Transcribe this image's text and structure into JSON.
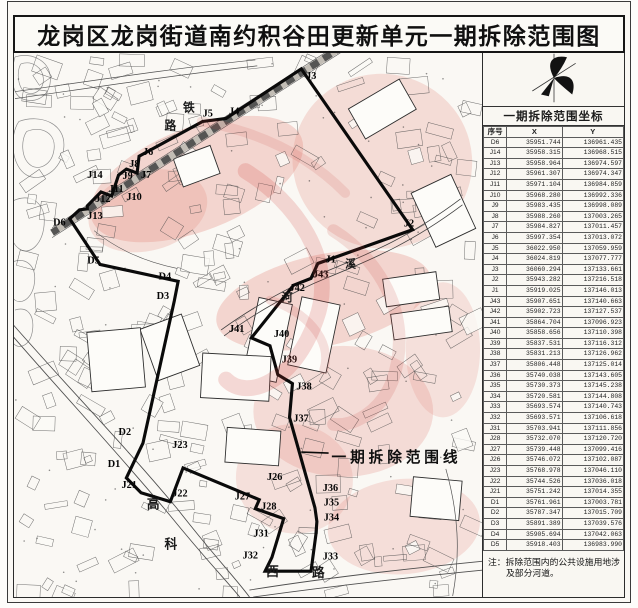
{
  "title": "龙岗区龙岗街道南约积谷田更新单元一期拆除范围图",
  "legend": {
    "label": "一期拆除范围线",
    "x": 338,
    "y": 463,
    "leader": [
      307,
      453,
      335,
      454
    ]
  },
  "note": "注：拆除范围内的公共设施用地涉及部分河道。",
  "colors": {
    "demolition_fill": "#e3847a",
    "boundary": "#0a0a0a",
    "watermark": "#cc3a33",
    "paper": "#faf8f4",
    "parcel_line": "#4a4a4a"
  },
  "map": {
    "railway_chars": [
      {
        "t": "铁",
        "x": 186,
        "y": 110
      },
      {
        "t": "路",
        "x": 167,
        "y": 128
      }
    ],
    "river_chars": [
      {
        "t": "溪",
        "x": 352,
        "y": 267
      },
      {
        "t": "河",
        "x": 287,
        "y": 301
      }
    ],
    "road_chars": [
      {
        "t": "高",
        "x": 149,
        "y": 510
      },
      {
        "t": "科",
        "x": 167,
        "y": 550
      },
      {
        "t": "西",
        "x": 271,
        "y": 578
      },
      {
        "t": "路",
        "x": 318,
        "y": 579
      }
    ],
    "vertices": [
      {
        "id": "D6",
        "vx": 70,
        "vy": 218,
        "lx": 53,
        "ly": 225
      },
      {
        "id": "J14",
        "vx": 80,
        "vy": 209,
        "lx": 88,
        "ly": 177
      },
      {
        "id": "J13",
        "vx": 88,
        "vy": 208,
        "lx": 88,
        "ly": 218
      },
      {
        "id": "J12",
        "vx": 88,
        "vy": 205,
        "lx": 96,
        "ly": 201
      },
      {
        "id": "J11",
        "vx": 102,
        "vy": 191,
        "lx": 110,
        "ly": 191
      },
      {
        "id": "J10",
        "vx": 113,
        "vy": 195,
        "lx": 128,
        "ly": 199
      },
      {
        "id": "J9",
        "vx": 120,
        "vy": 174,
        "lx": 124,
        "ly": 178
      },
      {
        "id": "J8",
        "vx": 128,
        "vy": 168,
        "lx": 131,
        "ly": 166
      },
      {
        "id": "J7",
        "vx": 139,
        "vy": 172,
        "lx": 143,
        "ly": 177
      },
      {
        "id": "J6",
        "vx": 141,
        "vy": 155,
        "lx": 145,
        "ly": 154
      },
      {
        "id": "J5",
        "vx": 206,
        "vy": 120,
        "lx": 206,
        "ly": 115
      },
      {
        "id": "J4",
        "vx": 230,
        "vy": 117,
        "lx": 233,
        "ly": 113
      },
      {
        "id": "J3",
        "vx": 307,
        "vy": 67,
        "lx": 312,
        "ly": 77
      },
      {
        "id": "J2",
        "vx": 421,
        "vy": 229,
        "lx": 412,
        "ly": 226
      },
      {
        "id": "J1",
        "vx": 324,
        "vy": 263,
        "lx": 332,
        "ly": 262
      },
      {
        "id": "J43",
        "vx": 317,
        "vy": 278,
        "lx": 319,
        "ly": 277
      },
      {
        "id": "J42",
        "vx": 299,
        "vy": 285,
        "lx": 295,
        "ly": 291
      },
      {
        "id": "J41",
        "vx": 256,
        "vy": 338,
        "lx": 233,
        "ly": 332
      },
      {
        "id": "J40",
        "vx": 275,
        "vy": 346,
        "lx": 279,
        "ly": 337
      },
      {
        "id": "J39",
        "vx": 283,
        "vy": 375,
        "lx": 287,
        "ly": 363
      },
      {
        "id": "J38",
        "vx": 298,
        "vy": 384,
        "lx": 302,
        "ly": 390
      },
      {
        "id": "J37",
        "vx": 295,
        "vy": 418,
        "lx": 299,
        "ly": 422
      },
      {
        "id": "J36",
        "vx": 321,
        "vy": 509,
        "lx": 329,
        "ly": 492
      },
      {
        "id": "J35",
        "vx": 323,
        "vy": 523,
        "lx": 330,
        "ly": 507
      },
      {
        "id": "J34",
        "vx": 322,
        "vy": 536,
        "lx": 330,
        "ly": 522
      },
      {
        "id": "J33",
        "vx": 317,
        "vy": 573,
        "lx": 329,
        "ly": 561
      },
      {
        "id": "J32",
        "vx": 270,
        "vy": 573,
        "lx": 247,
        "ly": 560
      },
      {
        "id": "J31",
        "vx": 277,
        "vy": 559,
        "lx": 258,
        "ly": 538
      },
      {
        "id": "J28",
        "vx": 289,
        "vy": 520,
        "lx": 266,
        "ly": 511
      },
      {
        "id": "J27",
        "vx": 260,
        "vy": 510,
        "lx": 239,
        "ly": 501
      },
      {
        "id": "J26",
        "vx": 264,
        "vy": 501,
        "lx": 272,
        "ly": 481
      },
      {
        "id": "J23",
        "vx": 186,
        "vy": 469,
        "lx": 175,
        "ly": 449
      },
      {
        "id": "J22",
        "vx": 173,
        "vy": 503,
        "lx": 175,
        "ly": 498
      },
      {
        "id": "J21",
        "vx": 143,
        "vy": 494,
        "lx": 123,
        "ly": 489
      },
      {
        "id": "D1",
        "vx": 128,
        "vy": 479,
        "lx": 109,
        "ly": 468
      },
      {
        "id": "D2",
        "vx": 145,
        "vy": 444,
        "lx": 120,
        "ly": 436
      },
      {
        "id": "D3",
        "vx": 177,
        "vy": 301,
        "lx": 159,
        "ly": 299
      },
      {
        "id": "D4",
        "vx": 181,
        "vy": 281,
        "lx": 161,
        "ly": 279
      },
      {
        "id": "D5",
        "vx": 101,
        "vy": 264,
        "lx": 88,
        "ly": 263
      }
    ]
  },
  "table": {
    "title": "一期拆除范围坐标",
    "columns": [
      "序号",
      "X",
      "Y"
    ],
    "rows": [
      [
        "D6",
        "35951.744",
        "136961.435"
      ],
      [
        "J14",
        "35958.315",
        "136968.515"
      ],
      [
        "J13",
        "35958.964",
        "136974.597"
      ],
      [
        "J12",
        "35961.307",
        "136974.347"
      ],
      [
        "J11",
        "35971.104",
        "136984.859"
      ],
      [
        "J10",
        "35968.280",
        "136992.336"
      ],
      [
        "J9",
        "35983.435",
        "136998.089"
      ],
      [
        "J8",
        "35988.260",
        "137003.265"
      ],
      [
        "J7",
        "35984.827",
        "137011.457"
      ],
      [
        "J6",
        "35997.354",
        "137013.072"
      ],
      [
        "J5",
        "36022.950",
        "137059.959"
      ],
      [
        "J4",
        "36024.819",
        "137077.777"
      ],
      [
        "J3",
        "36060.294",
        "137133.661"
      ],
      [
        "J2",
        "35943.282",
        "137216.518"
      ],
      [
        "J1",
        "35919.025",
        "137146.013"
      ],
      [
        "J43",
        "35907.651",
        "137140.663"
      ],
      [
        "J42",
        "35902.723",
        "137127.537"
      ],
      [
        "J41",
        "35864.704",
        "137096.923"
      ],
      [
        "J40",
        "35858.656",
        "137110.398"
      ],
      [
        "J39",
        "35837.531",
        "137116.312"
      ],
      [
        "J38",
        "35831.213",
        "137126.962"
      ],
      [
        "J37",
        "35806.448",
        "137125.014"
      ],
      [
        "J36",
        "35740.038",
        "137143.605"
      ],
      [
        "J35",
        "35730.373",
        "137145.238"
      ],
      [
        "J34",
        "35720.581",
        "137144.808"
      ],
      [
        "J33",
        "35693.574",
        "137140.743"
      ],
      [
        "J32",
        "35693.571",
        "137106.618"
      ],
      [
        "J31",
        "35703.941",
        "137111.856"
      ],
      [
        "J28",
        "35732.070",
        "137120.720"
      ],
      [
        "J27",
        "35739.448",
        "137099.416"
      ],
      [
        "J26",
        "35746.072",
        "137102.087"
      ],
      [
        "J23",
        "35768.978",
        "137046.110"
      ],
      [
        "J22",
        "35744.526",
        "137036.018"
      ],
      [
        "J21",
        "35751.242",
        "137014.355"
      ],
      [
        "D1",
        "35761.961",
        "137003.781"
      ],
      [
        "D2",
        "35787.347",
        "137015.709"
      ],
      [
        "D3",
        "35891.389",
        "137039.576"
      ],
      [
        "D4",
        "35905.694",
        "137042.063"
      ],
      [
        "D5",
        "35918.403",
        "136983.990"
      ]
    ]
  }
}
